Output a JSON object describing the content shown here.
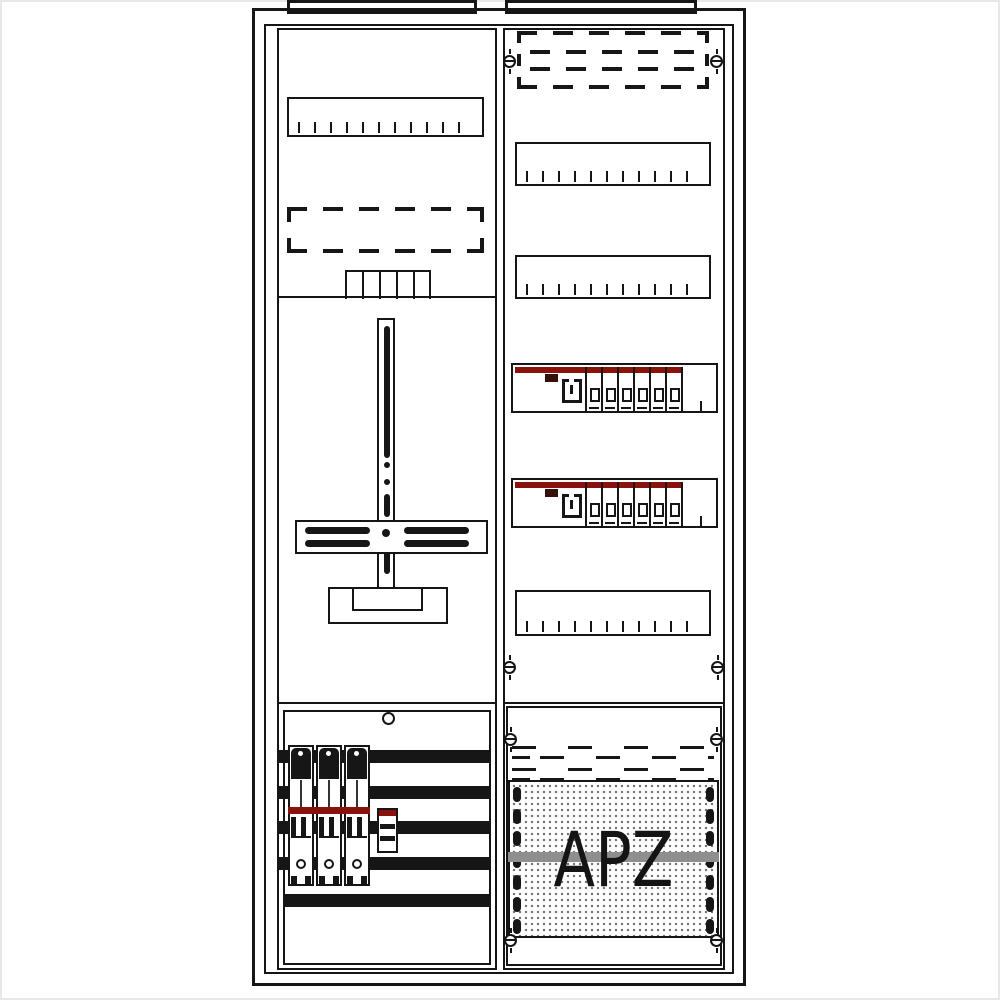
{
  "colors": {
    "ink": "#161616",
    "accent_red": "#8a120d",
    "gray_band": "#8f8f8f",
    "perforation_dot": "#6f6f6f",
    "background": "#ffffff"
  },
  "left_column": {
    "rail_cover": {
      "tick_count": 12
    },
    "dashed_reserve_box": {
      "rows": 2
    },
    "comb_cells": 5,
    "meter_cross": {
      "side_slots_per_side": 2
    },
    "bottom": {
      "busbar_count": 5,
      "busbar_end_tabs": 4,
      "fuse_unit_count": 3
    }
  },
  "right_column": {
    "dashed_reserve_rows": 4,
    "rail_covers": [
      {
        "tick_count": 11
      },
      {
        "tick_count": 11
      },
      {
        "tick_count": 11
      }
    ],
    "breaker_rows": [
      {
        "module_count": 6
      },
      {
        "module_count": 6
      }
    ],
    "screw_count": 4
  },
  "apz": {
    "label": "APZ",
    "perforation_ovals_per_side": 7,
    "screw_count": 4,
    "squarewave_dash_rows": 2
  }
}
